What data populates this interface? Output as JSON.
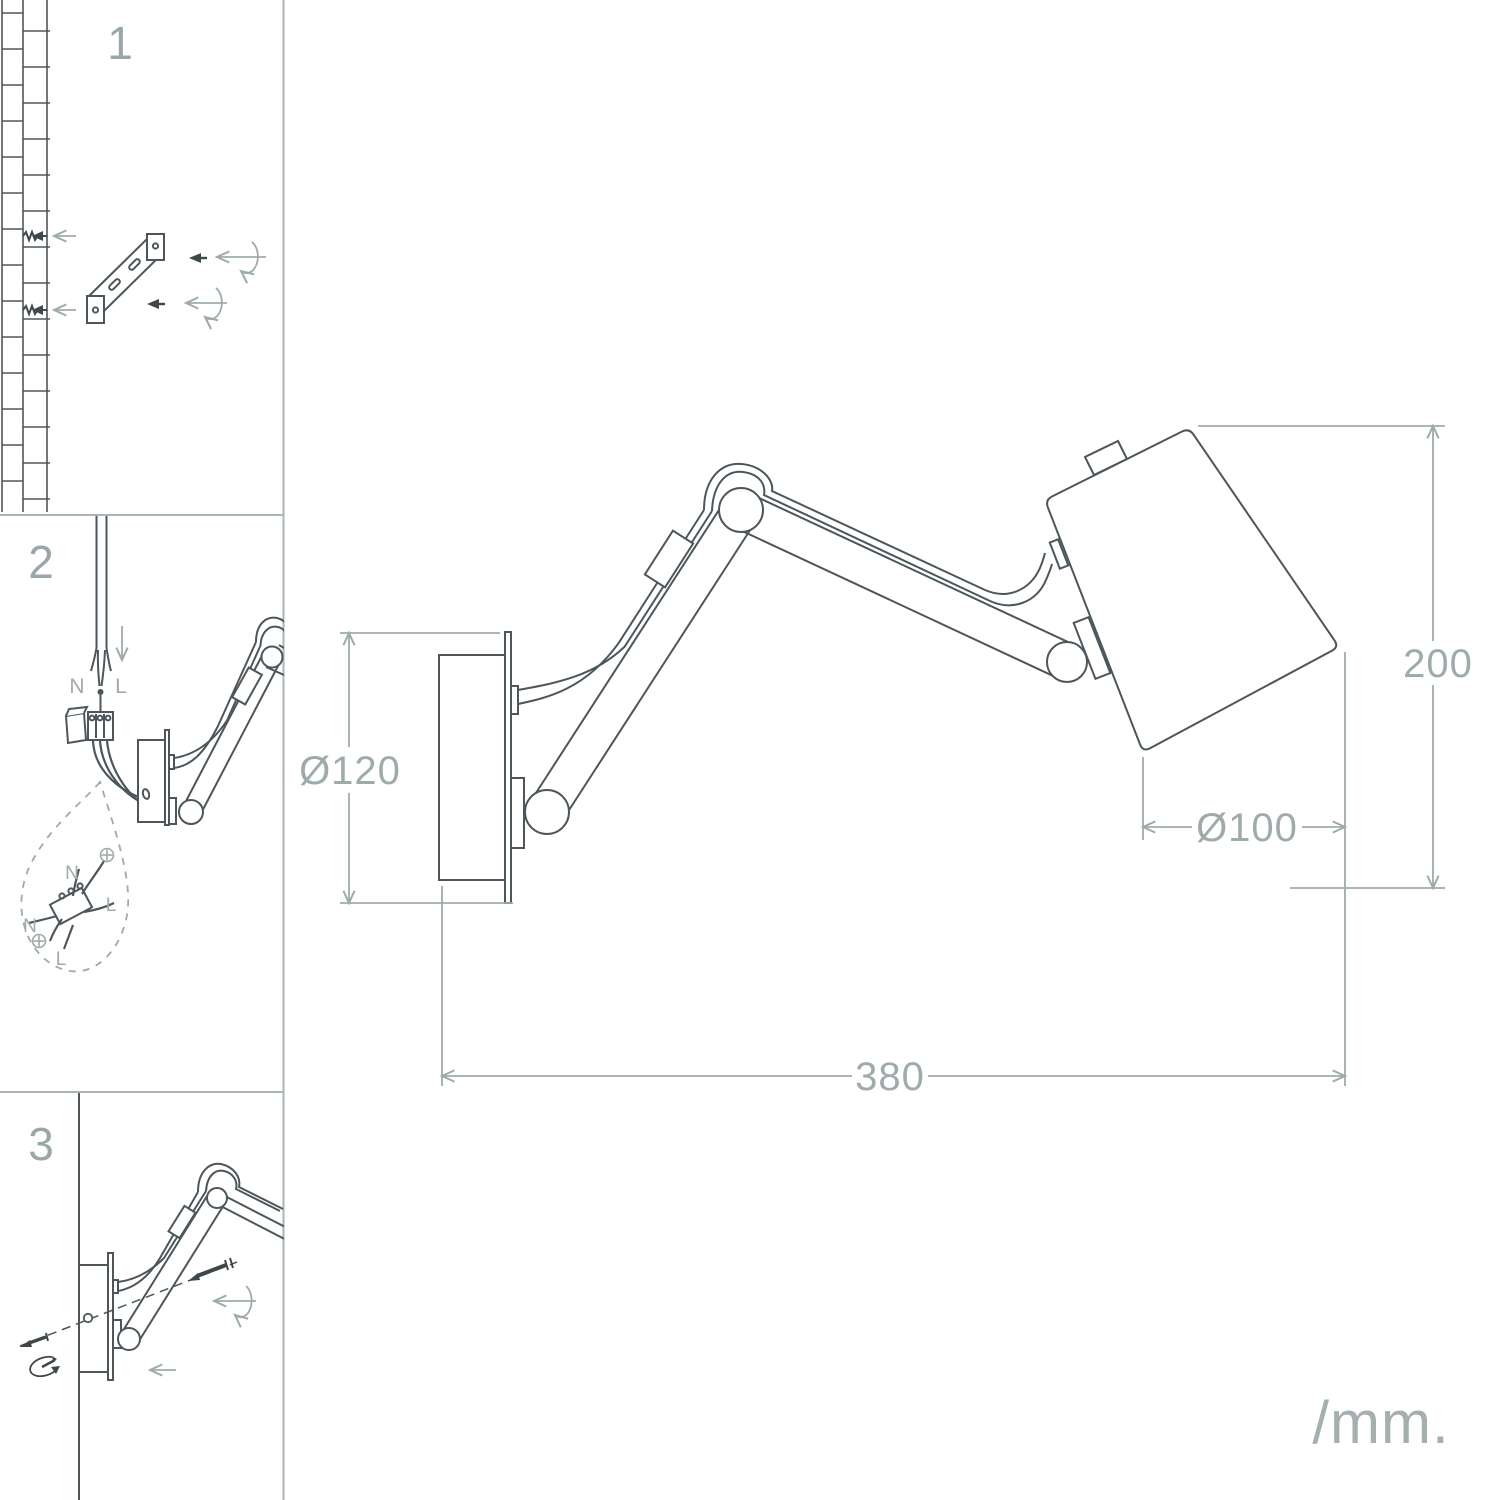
{
  "colors": {
    "background": "#ffffff",
    "line_dark": "#4d565a",
    "line_light": "#9fabab",
    "label_light": "#9aa7a8"
  },
  "steps": {
    "step1": {
      "number": "1"
    },
    "step2": {
      "number": "2",
      "cable_labels": {
        "neutral": "N",
        "live": "L"
      },
      "bubble_labels": {
        "neutral_top": "N",
        "live_right": "L",
        "neutral_left": "N",
        "live_bottom": "L"
      }
    },
    "step3": {
      "number": "3"
    }
  },
  "main_drawing": {
    "dimensions": {
      "plate_diameter": "Ø120",
      "height": "200",
      "shade_diameter": "Ø100",
      "width": "380"
    },
    "units_label": "/mm."
  },
  "icons": {
    "earth": "earth-ground-symbol",
    "left_arrow": "left-arrow",
    "down_arrow": "down-arrow",
    "rotate": "rotation-arrow",
    "screw": "screw"
  }
}
